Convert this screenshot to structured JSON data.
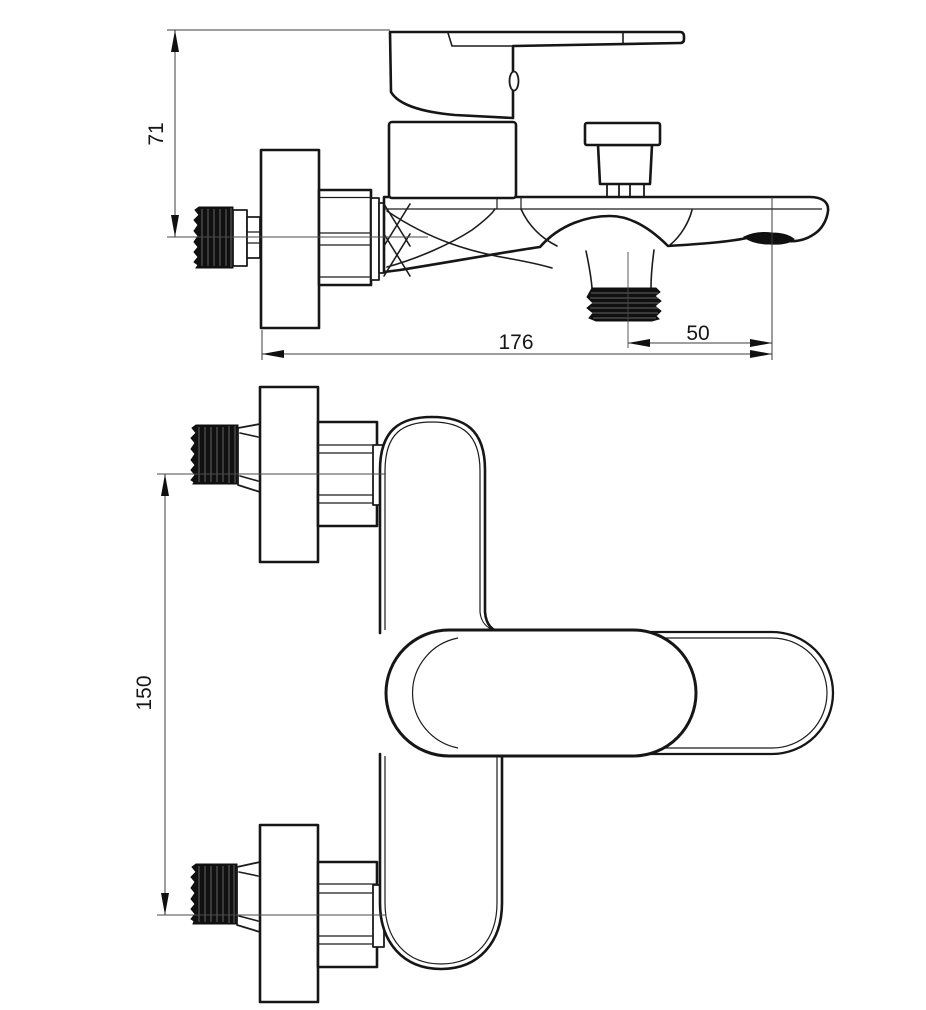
{
  "drawing": {
    "type": "technical-dimension-drawing",
    "subject": "wall-mounted bath shower mixer tap, side view and front view",
    "colors": {
      "line": "#161616",
      "background": "#ffffff",
      "fill": "#ffffff"
    },
    "dimensions": {
      "handle_height": "71",
      "spout_reach": "176",
      "shower_outlet_offset": "50",
      "connection_centers": "150"
    }
  }
}
